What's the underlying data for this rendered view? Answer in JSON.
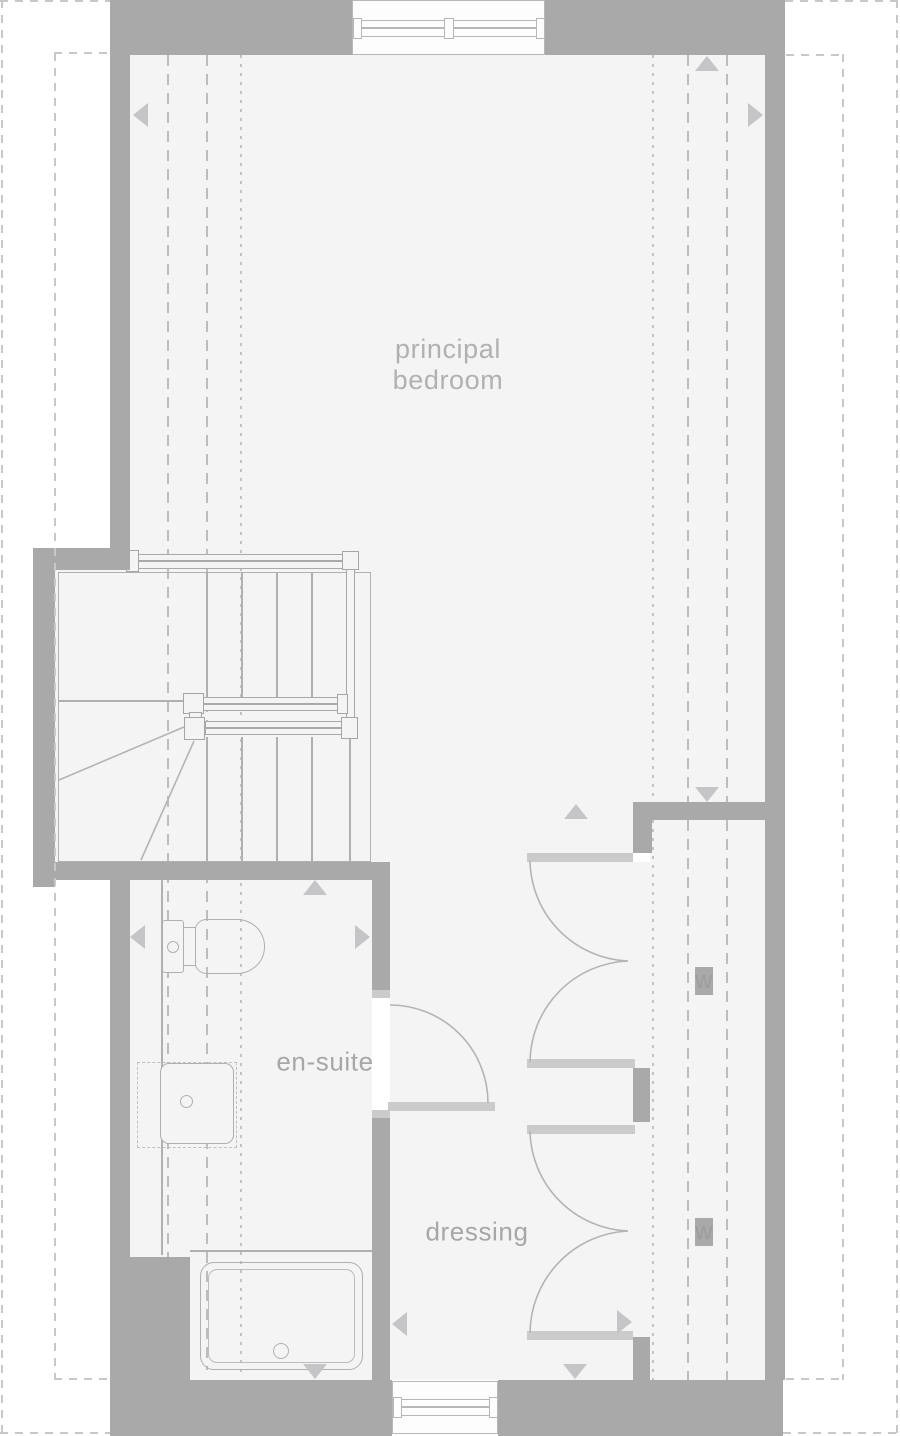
{
  "plan": {
    "kind": "residential floor plan",
    "rooms_shown": [
      "principal bedroom",
      "en-suite",
      "dressing"
    ]
  },
  "colors": {
    "wall": "#a9a9a9",
    "floor": "#f4f4f5",
    "outline": "#b0b0b2",
    "dash": "#bdbdbd",
    "fine": "#c3c3c5",
    "jamb": "#cbcbcb",
    "arrow": "#c5c5c7",
    "label": "#a7a7a9",
    "bg": "#ffffff",
    "win": "#fdfdfd",
    "winline": "#b7b7b9"
  },
  "rooms": {
    "principal_bedroom": {
      "line1": "principal",
      "line2": "bedroom"
    },
    "en_suite": {
      "label": "en-suite"
    },
    "dressing": {
      "label": "dressing"
    }
  },
  "wardrobes": {
    "top": {
      "label": "w"
    },
    "bottom": {
      "label": "w"
    }
  },
  "fixtures": {
    "stairs": "winder-staircase",
    "toilet": "toilet",
    "basin": "wash-basin",
    "shower": "shower-tray",
    "windows": [
      "top-window",
      "bottom-window"
    ]
  },
  "markers": {
    "arrow_directions": [
      "left",
      "up",
      "right",
      "down",
      "up",
      "up",
      "left",
      "right",
      "left",
      "right",
      "down",
      "down"
    ]
  }
}
